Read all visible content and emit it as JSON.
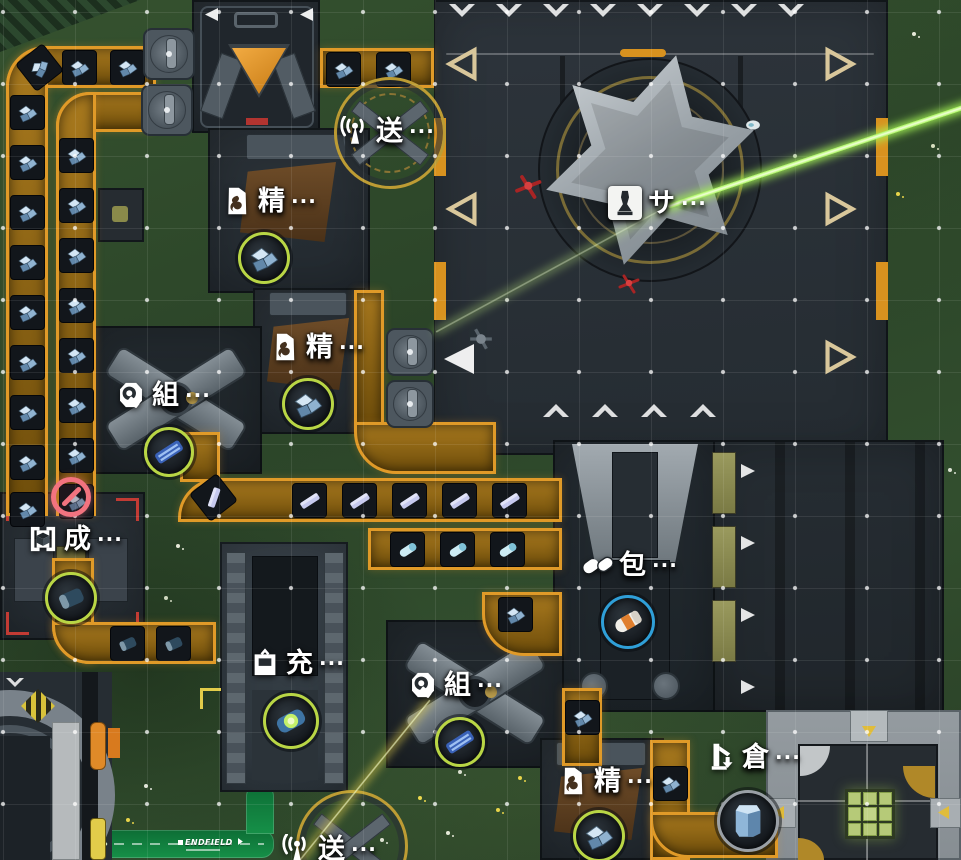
{
  "labels": {
    "ellipsis": "···"
  },
  "colors": {
    "belt_orange": "#e09a28",
    "ring_green": "#b9d645",
    "ring_blue": "#2f9fd8",
    "ring_gray": "#9aa0a6",
    "laser_green": "#a5f455",
    "alert_pink": "#f2737f",
    "road_green": "#12823f"
  },
  "road": {
    "label": "ENDFIELD"
  },
  "machines": [
    {
      "id": "transmitter-top",
      "name": "送",
      "icon": "antenna-icon",
      "x": 340,
      "y": 116
    },
    {
      "id": "refiner-1",
      "name": "精",
      "icon": "refine-icon",
      "x": 222,
      "y": 186
    },
    {
      "id": "silo-tower",
      "name": "サ",
      "icon": "silo-icon",
      "boxed": true,
      "x": 608,
      "y": 186
    },
    {
      "id": "refiner-2",
      "name": "精",
      "icon": "refine-icon",
      "x": 270,
      "y": 332
    },
    {
      "id": "assembler-1",
      "name": "組",
      "icon": "assemble-icon",
      "x": 116,
      "y": 380
    },
    {
      "id": "former",
      "name": "成",
      "icon": "form-icon",
      "x": 28,
      "y": 524
    },
    {
      "id": "packer",
      "name": "包",
      "icon": "pack-icon",
      "x": 583,
      "y": 550
    },
    {
      "id": "charger",
      "name": "充",
      "icon": "charge-icon",
      "x": 250,
      "y": 648
    },
    {
      "id": "assembler-2",
      "name": "組",
      "icon": "assemble-icon",
      "x": 408,
      "y": 670
    },
    {
      "id": "warehouse",
      "name": "倉",
      "icon": "warehouse-icon",
      "x": 706,
      "y": 742
    },
    {
      "id": "refiner-3",
      "name": "精",
      "icon": "refine-icon",
      "x": 558,
      "y": 766
    },
    {
      "id": "transmitter-bottom",
      "name": "送",
      "icon": "antenna-icon",
      "x": 282,
      "y": 834
    }
  ],
  "item_rings": [
    {
      "machine": "refiner-1",
      "item": "ore",
      "ring": "#b9d645",
      "x": 264,
      "y": 258,
      "r": 26
    },
    {
      "machine": "refiner-2",
      "item": "ore",
      "ring": "#b9d645",
      "x": 308,
      "y": 404,
      "r": 26
    },
    {
      "machine": "assembler-1",
      "item": "board",
      "ring": "#b9d645",
      "x": 169,
      "y": 452,
      "r": 25
    },
    {
      "machine": "former",
      "item": "cell",
      "ring": "#b9d645",
      "x": 71,
      "y": 598,
      "r": 26
    },
    {
      "machine": "packer",
      "item": "ocapsule",
      "ring": "#2f9fd8",
      "x": 628,
      "y": 622,
      "r": 27
    },
    {
      "machine": "charger",
      "item": "glowcell",
      "ring": "#b9d645",
      "x": 291,
      "y": 721,
      "r": 28
    },
    {
      "machine": "assembler-2",
      "item": "board",
      "ring": "#b9d645",
      "x": 460,
      "y": 742,
      "r": 25
    },
    {
      "machine": "refiner-3",
      "item": "ore",
      "ring": "#b9d645",
      "x": 599,
      "y": 836,
      "r": 26
    },
    {
      "machine": "warehouse",
      "item": "stack",
      "ring": "#9aa0a6",
      "x": 748,
      "y": 821,
      "r": 31
    }
  ],
  "status_icons": [
    {
      "type": "blocked",
      "x": 71,
      "y": 497,
      "color": "#f2737f"
    }
  ],
  "belts": [
    [
      6,
      46,
      150,
      42,
      "40px 0 0 0"
    ],
    [
      6,
      46,
      42,
      470,
      "40px 0 0 0"
    ],
    [
      56,
      92,
      98,
      40,
      "34px 0 0 0"
    ],
    [
      56,
      92,
      40,
      424,
      "34px 0 0 0"
    ],
    [
      320,
      48,
      114,
      40,
      "0"
    ],
    [
      180,
      432,
      40,
      50,
      "0"
    ],
    [
      178,
      478,
      384,
      44,
      "40px 0 0 0"
    ],
    [
      368,
      528,
      194,
      42,
      "0"
    ],
    [
      354,
      290,
      30,
      140,
      "0"
    ],
    [
      354,
      422,
      142,
      52,
      "0 0 0 42px"
    ],
    [
      52,
      558,
      42,
      106,
      "0 0 0 38px"
    ],
    [
      52,
      622,
      164,
      42,
      "0 0 0 38px"
    ],
    [
      482,
      592,
      80,
      64,
      "0 0 0 42px"
    ],
    [
      562,
      688,
      40,
      78,
      "0"
    ],
    [
      650,
      740,
      40,
      120,
      "0"
    ],
    [
      650,
      812,
      128,
      46,
      "0 0 0 38px"
    ]
  ],
  "belt_items": [
    [
      10,
      95,
      "ore",
      0
    ],
    [
      10,
      145,
      "ore",
      0
    ],
    [
      10,
      195,
      "ore",
      0
    ],
    [
      10,
      245,
      "ore",
      0
    ],
    [
      10,
      295,
      "ore",
      0
    ],
    [
      10,
      345,
      "ore",
      0
    ],
    [
      10,
      395,
      "ore",
      0
    ],
    [
      10,
      445,
      "ore",
      0
    ],
    [
      10,
      492,
      "ore",
      0
    ],
    [
      59,
      138,
      "ore",
      0
    ],
    [
      59,
      188,
      "ore",
      0
    ],
    [
      59,
      238,
      "ore",
      0
    ],
    [
      59,
      288,
      "ore",
      0
    ],
    [
      59,
      338,
      "ore",
      0
    ],
    [
      59,
      388,
      "ore",
      0
    ],
    [
      59,
      438,
      "ore",
      0
    ],
    [
      59,
      484,
      "ore",
      0
    ],
    [
      22,
      50,
      "ore",
      -38
    ],
    [
      62,
      50,
      "ore",
      0
    ],
    [
      110,
      50,
      "ore",
      0
    ],
    [
      326,
      52,
      "ore",
      0
    ],
    [
      376,
      52,
      "ore",
      0
    ],
    [
      196,
      480,
      "ingot",
      -38
    ],
    [
      292,
      483,
      "ingot",
      0
    ],
    [
      342,
      483,
      "ingot",
      0
    ],
    [
      392,
      483,
      "ingot",
      0
    ],
    [
      442,
      483,
      "ingot",
      0
    ],
    [
      492,
      483,
      "ingot",
      0
    ],
    [
      390,
      532,
      "capsule",
      0
    ],
    [
      440,
      532,
      "capsule",
      0
    ],
    [
      490,
      532,
      "capsule",
      0
    ],
    [
      110,
      626,
      "cell",
      0
    ],
    [
      156,
      626,
      "cell",
      0
    ],
    [
      498,
      597,
      "ore",
      0
    ],
    [
      565,
      700,
      "ore",
      0
    ],
    [
      653,
      766,
      "ore",
      0
    ]
  ],
  "grabbers": [
    [
      143,
      28,
      52
    ],
    [
      141,
      84,
      52
    ],
    [
      386,
      328,
      48
    ],
    [
      386,
      380,
      48
    ]
  ],
  "arrows": [
    [
      "chev-down",
      449,
      4,
      26
    ],
    [
      "chev-down",
      496,
      4,
      26
    ],
    [
      "chev-down",
      543,
      4,
      26
    ],
    [
      "chev-down",
      590,
      4,
      26
    ],
    [
      "chev-down",
      637,
      4,
      26
    ],
    [
      "chev-down",
      684,
      4,
      26
    ],
    [
      "chev-down",
      731,
      4,
      26
    ],
    [
      "chev-down",
      778,
      4,
      26
    ],
    [
      "chev-up",
      543,
      404,
      26
    ],
    [
      "chev-up",
      592,
      404,
      26
    ],
    [
      "chev-up",
      641,
      404,
      26
    ],
    [
      "chev-up",
      690,
      404,
      26
    ],
    [
      "tri-left-outline",
      444,
      46,
      36
    ],
    [
      "tri-left-outline",
      444,
      191,
      36
    ],
    [
      "tri-left-fill",
      444,
      344,
      30
    ],
    [
      "tri-right-outline",
      822,
      46,
      36
    ],
    [
      "tri-right-outline",
      822,
      191,
      36
    ],
    [
      "tri-right-outline",
      822,
      339,
      36
    ],
    [
      "tri-right-fill",
      741,
      464,
      14
    ],
    [
      "tri-right-fill",
      741,
      536,
      14
    ],
    [
      "tri-right-fill",
      741,
      608,
      14
    ],
    [
      "tri-right-fill",
      741,
      680,
      14
    ],
    [
      "tri-left-fill",
      205,
      8,
      13
    ],
    [
      "tri-left-fill",
      300,
      8,
      13
    ],
    [
      "chev-down",
      6,
      678,
      18
    ]
  ],
  "lasers": [
    [
      975,
      103,
      668,
      206,
      5,
      "#a5f455",
      1
    ],
    [
      668,
      206,
      436,
      332,
      2,
      "#bde87e",
      0.5
    ],
    [
      430,
      700,
      300,
      860,
      2,
      "#d9c64a",
      0.75
    ]
  ],
  "characters": [
    [
      "red-operator",
      512,
      172,
      30
    ],
    [
      "red-operator",
      616,
      272,
      24
    ],
    [
      "gray-drone",
      468,
      326,
      26
    ],
    [
      "white-drone",
      742,
      114,
      22
    ]
  ],
  "flowers": [
    [
      914,
      34,
      "#e6e9d8"
    ],
    [
      933,
      146,
      "#d8e0c0"
    ],
    [
      898,
      194,
      "#e8d44a"
    ],
    [
      700,
      690,
      "#e4e8e0"
    ],
    [
      735,
      700,
      "#e8d44a"
    ],
    [
      545,
      686,
      "#dfe3da"
    ],
    [
      420,
      798,
      "#ecd94e"
    ],
    [
      448,
      833,
      "#e6e9d8"
    ],
    [
      498,
      810,
      "#e8d44a"
    ],
    [
      382,
      840,
      "#dde2d2"
    ],
    [
      178,
      546,
      "#e6e9d8"
    ],
    [
      166,
      598,
      "#cfd8c0"
    ],
    [
      905,
      686,
      "#d2d8c8"
    ],
    [
      520,
      778,
      "#e8d44a"
    ],
    [
      146,
      786,
      "#e2e6da"
    ],
    [
      128,
      820,
      "#e8d44a"
    ],
    [
      460,
      772,
      "#dbe0d0"
    ],
    [
      950,
      470,
      "#dde2d4"
    ]
  ]
}
